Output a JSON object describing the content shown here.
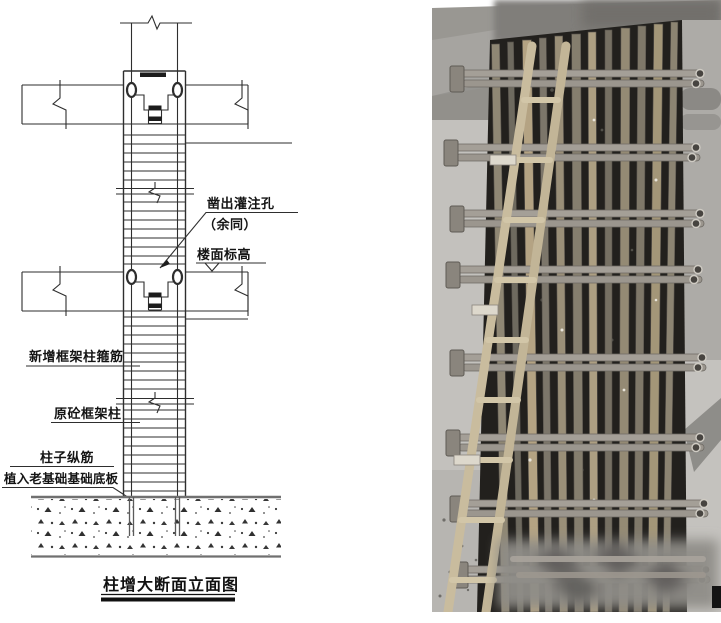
{
  "figure": {
    "type": "construction-detail-figure",
    "diagram": {
      "title": "柱增大断面立面图",
      "labels": {
        "pour_hole_line1": "凿出灌注孔",
        "pour_hole_line2": "（余同）",
        "floor_elevation": "楼面标高",
        "new_stirrups": "新增框架柱箍筋",
        "original_column": "原砼框架柱",
        "dowel_line1": "柱子纵筋",
        "dowel_line2": "植入老基础基础底板"
      },
      "line_color": "#2e2e2e",
      "foundation_line_color": "#707070"
    },
    "photo": {
      "content": "column-enlargement-rebar-and-scaffold-photo",
      "colors": {
        "wall_gray": "#b3b1ad",
        "ceiling_gray": "#999792",
        "column_dark": "#22201d",
        "rebar_tan": "#a89878",
        "tube_gray": "#a49f97",
        "ladder_tan": "#c9bc9e",
        "corner_mark_black": "#141414"
      }
    }
  }
}
